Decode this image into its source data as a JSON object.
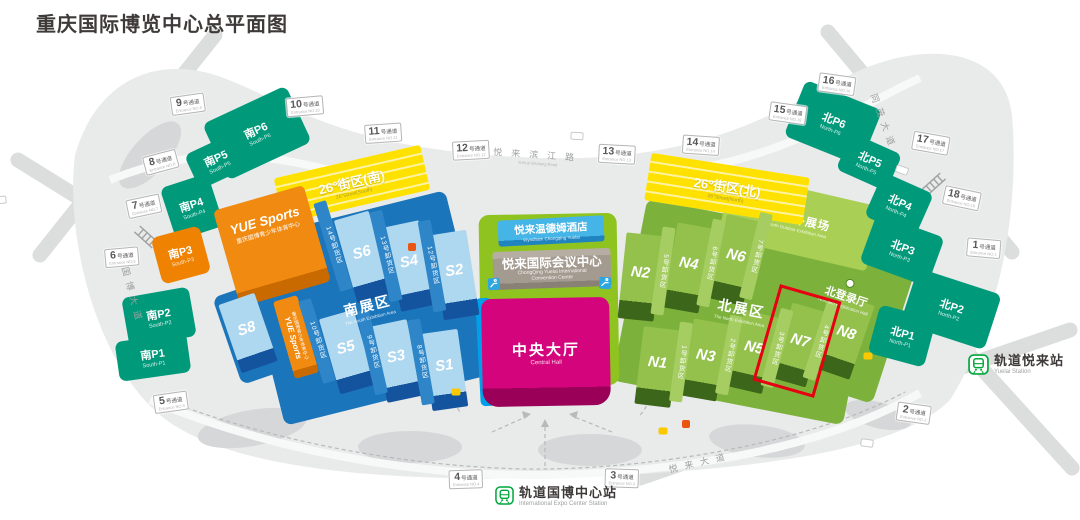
{
  "title": "重庆国际博览中心总平面图",
  "colors": {
    "parking_green": "#00997a",
    "orange": "#ef8200",
    "hall_blue_top": "#aed7f0",
    "platform_blue": "#1b75bb",
    "loading_blue": "#2e86c8",
    "hall_green_top": "#93c14c",
    "platform_green": "#7cb23c",
    "loading_green": "#a5cd62",
    "outdoor_green": "#a9cf55",
    "lime_base": "#8fc31f",
    "central_magenta": "#d4057c",
    "convention_taupe": "#a39a90",
    "hotel_blue": "#35a9dc",
    "street_yellow": "#ffe100",
    "highlight_red": "#e60012",
    "metro_green": "#00a73c",
    "ground_gray": "#e9eaea",
    "cyan_edge": "#00a0e9"
  },
  "icons": {
    "metro": "train-in-rounded-square",
    "escalator": "escalator-blue-square",
    "bus_stop": "yellow-bus-marker",
    "gate": "red-gate-marker",
    "registration": "green-circle-marker"
  },
  "south": {
    "zone": "南展区",
    "zone_en": "The South Exhibition Area",
    "halls": {
      "s1": "S1",
      "s2": "S2",
      "s3": "S3",
      "s4": "S4",
      "s5": "S5",
      "s6": "S6",
      "s8": "S8"
    },
    "loading": {
      "z8": "8号卸货区",
      "z9": "9号卸货区",
      "z10": "10号卸货区",
      "z12": "12号卸货区",
      "z13": "13号卸货区",
      "z14": "14号卸货区"
    }
  },
  "north": {
    "zone": "北展区",
    "zone_en": "The North Exhibition Area",
    "outdoor": "北室外展场",
    "outdoor_en": "North Outdoor Exhibition Area",
    "registration": "北登录厅",
    "registration_en": "Northern Registration Hall",
    "halls": {
      "n1": "N1",
      "n2": "N2",
      "n3": "N3",
      "n4": "N4",
      "n5": "N5",
      "n6": "N6",
      "n7": "N7",
      "n8": "N8"
    },
    "loading": {
      "z1": "1号卸货区",
      "z2": "2号卸货区",
      "z3": "3号卸货区",
      "z4": "4号卸货区",
      "z5": "5号卸货区",
      "z6": "6号卸货区",
      "z7": "7号卸货区"
    }
  },
  "center": {
    "hotel": "悦来温德姆酒店",
    "hotel_en": "Wyndham Chongqing Yuelai",
    "convention": "悦来国际会议中心",
    "convention_en1": "ChongQing Yuelai International",
    "convention_en2": "Convention Center",
    "hall": "中央大厅",
    "hall_en": "Central Hall"
  },
  "yue": {
    "name": "YUE Sports",
    "sub": "重庆国博青少年体育中心"
  },
  "street26": {
    "south": "26°街区(南)",
    "south_en": "26°Street(South)",
    "north": "26°街区(北)",
    "north_en": "26°Street(North)"
  },
  "parking": {
    "sp1": {
      "cn": "南P1",
      "en": "South-P1"
    },
    "sp2": {
      "cn": "南P2",
      "en": "South-P2"
    },
    "sp3": {
      "cn": "南P3",
      "en": "South-P3"
    },
    "sp4": {
      "cn": "南P4",
      "en": "South-P4"
    },
    "sp5": {
      "cn": "南P5",
      "en": "South-P5"
    },
    "sp6": {
      "cn": "南P6",
      "en": "South-P6"
    },
    "np1": {
      "cn": "北P1",
      "en": "North-P1"
    },
    "np2": {
      "cn": "北P2",
      "en": "North-P2"
    },
    "np3": {
      "cn": "北P3",
      "en": "North-P3"
    },
    "np4": {
      "cn": "北P4",
      "en": "North-P4"
    },
    "np5": {
      "cn": "北P5",
      "en": "North-P5"
    },
    "np6": {
      "cn": "北P6",
      "en": "North-P6"
    }
  },
  "passages": {
    "p1": {
      "num": "1",
      "suffix": "号通道",
      "en": "Entrance NO.1"
    },
    "p2": {
      "num": "2",
      "suffix": "号通道",
      "en": "Entrance NO.2"
    },
    "p3": {
      "num": "3",
      "suffix": "号通道",
      "en": "Entrance NO.3"
    },
    "p4": {
      "num": "4",
      "suffix": "号通道",
      "en": "Entrance NO.4"
    },
    "p5": {
      "num": "5",
      "suffix": "号通道",
      "en": "Entrance NO.5"
    },
    "p6": {
      "num": "6",
      "suffix": "号通道",
      "en": "Entrance NO.6"
    },
    "p7": {
      "num": "7",
      "suffix": "号通道",
      "en": "Entrance NO.7"
    },
    "p8": {
      "num": "8",
      "suffix": "号通道",
      "en": "Entrance NO.8"
    },
    "p9": {
      "num": "9",
      "suffix": "号通道",
      "en": "Entrance NO.9"
    },
    "p10": {
      "num": "10",
      "suffix": "号通道",
      "en": "Entrance NO.10"
    },
    "p11": {
      "num": "11",
      "suffix": "号通道",
      "en": "Entrance NO.11"
    },
    "p12": {
      "num": "12",
      "suffix": "号通道",
      "en": "Entrance NO.12"
    },
    "p13": {
      "num": "13",
      "suffix": "号通道",
      "en": "Entrance NO.13"
    },
    "p14": {
      "num": "14",
      "suffix": "号通道",
      "en": "Entrance NO.14"
    },
    "p15": {
      "num": "15",
      "suffix": "号通道",
      "en": "Entrance NO.15"
    },
    "p16": {
      "num": "16",
      "suffix": "号通道",
      "en": "Entrance NO.16"
    },
    "p17": {
      "num": "17",
      "suffix": "号通道",
      "en": "Entrance NO.17"
    },
    "p18": {
      "num": "18",
      "suffix": "号通道",
      "en": "Entrance NO.18"
    }
  },
  "stations": {
    "expo": {
      "cn": "轨道国博中心站",
      "en": "International Expo Center Station"
    },
    "yuelai": {
      "cn": "轨道悦来站",
      "en": "Yuelai Station"
    }
  },
  "roads": {
    "guobo": "国博大道",
    "binjiang": "悦来滨江路",
    "binjiang_en": "YueLai BinJiang Road",
    "tongmao": "同茂大道",
    "yuelai_ave": "悦来大道"
  }
}
